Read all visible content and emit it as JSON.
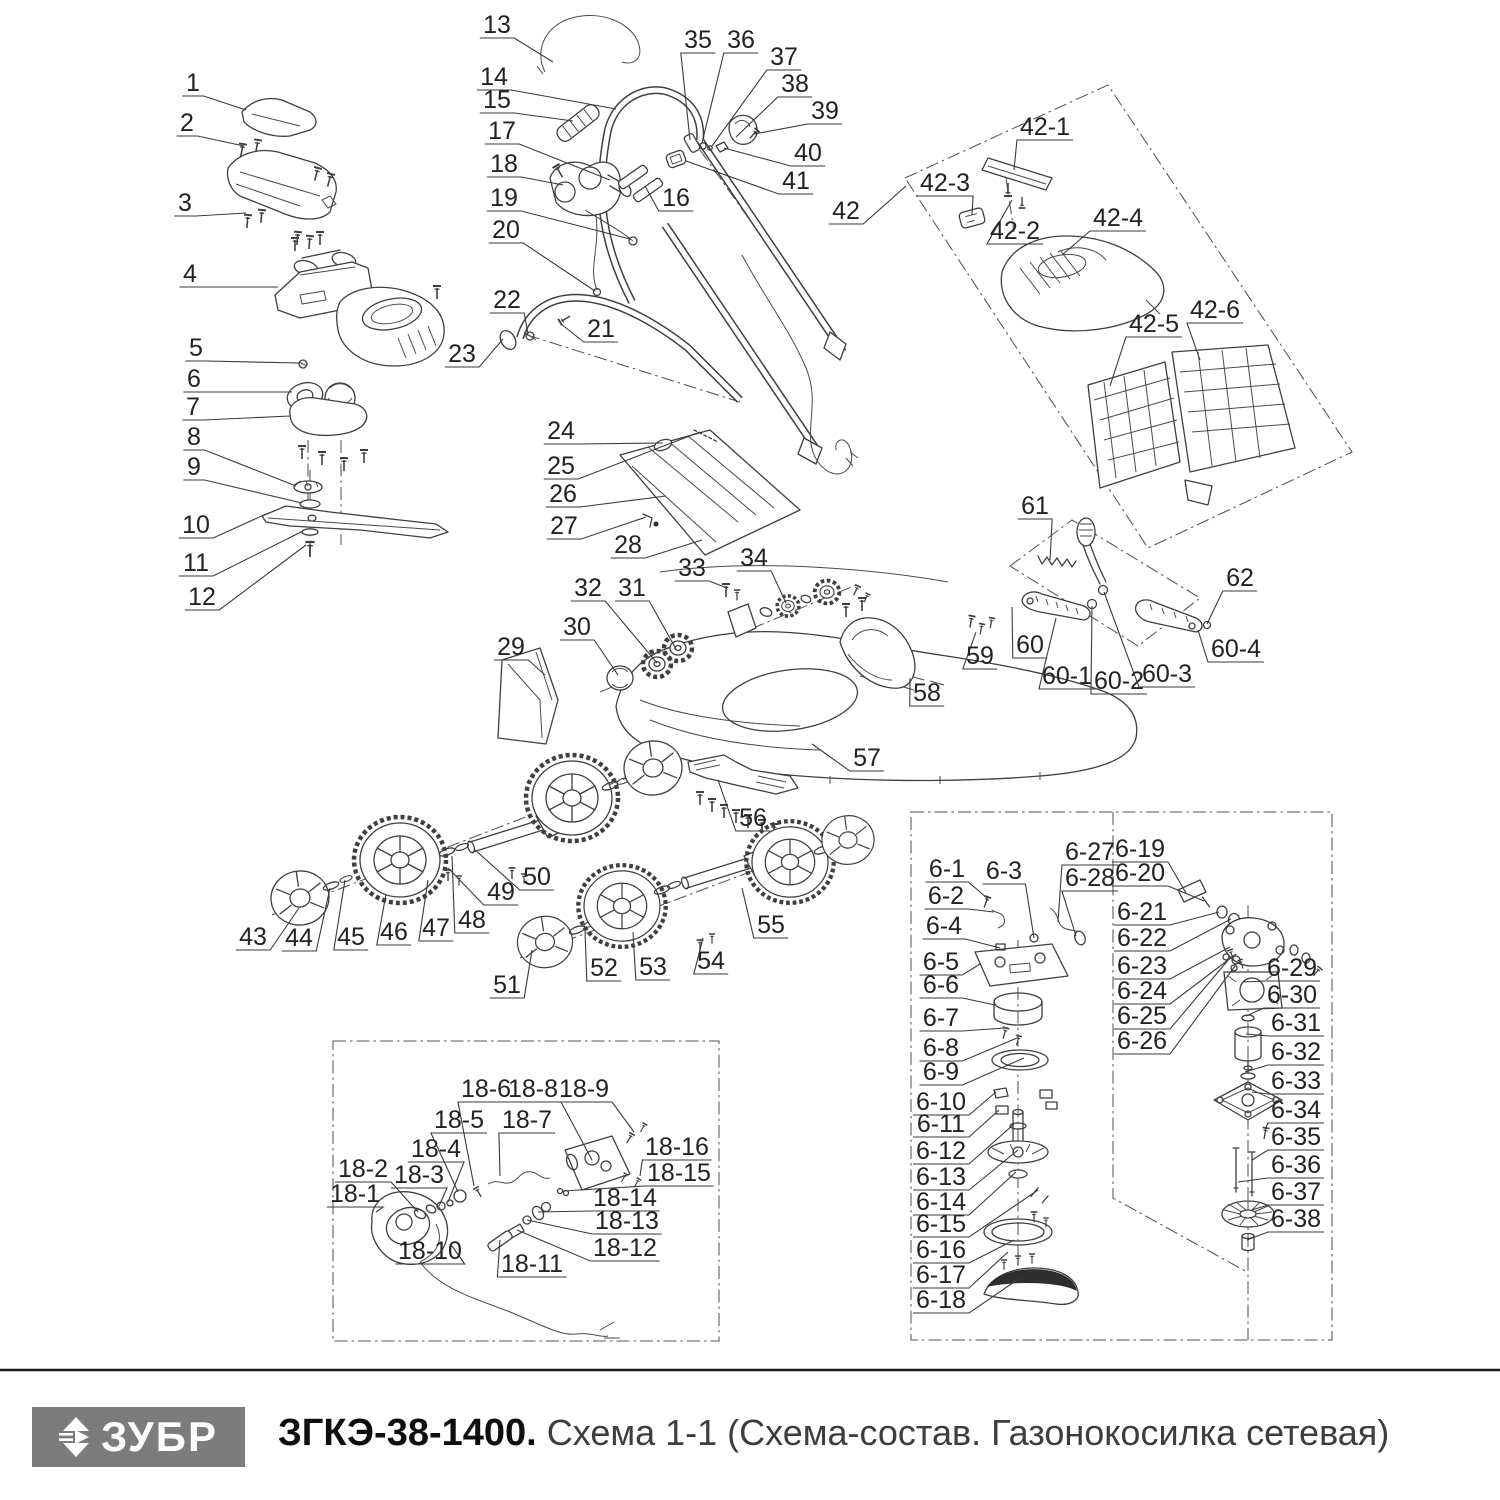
{
  "footer": {
    "logo_text": "ЗУБР",
    "model": "ЗГКЭ-38-1400.",
    "schema_title": "Схема 1-1 (Схема-состав. Газонокосилка сетевая)"
  },
  "callouts": [
    {
      "n": "1",
      "x": 193,
      "y": 82,
      "tx": 246,
      "ty": 110
    },
    {
      "n": "2",
      "x": 187,
      "y": 122,
      "tx": 244,
      "ty": 146
    },
    {
      "n": "3",
      "x": 185,
      "y": 202,
      "tx": 246,
      "ty": 213
    },
    {
      "n": "4",
      "x": 190,
      "y": 273,
      "tx": 278,
      "ty": 287
    },
    {
      "n": "5",
      "x": 196,
      "y": 347,
      "tx": 300,
      "ty": 363
    },
    {
      "n": "6",
      "x": 194,
      "y": 378,
      "tx": 292,
      "ty": 392
    },
    {
      "n": "7",
      "x": 193,
      "y": 406,
      "tx": 290,
      "ty": 416
    },
    {
      "n": "8",
      "x": 194,
      "y": 436,
      "tx": 296,
      "ty": 486
    },
    {
      "n": "9",
      "x": 194,
      "y": 466,
      "tx": 302,
      "ty": 503
    },
    {
      "n": "10",
      "x": 196,
      "y": 524,
      "tx": 266,
      "ty": 514
    },
    {
      "n": "11",
      "x": 196,
      "y": 562,
      "tx": 303,
      "ty": 531
    },
    {
      "n": "12",
      "x": 202,
      "y": 596,
      "tx": 306,
      "ty": 545
    },
    {
      "n": "13",
      "x": 497,
      "y": 24,
      "tx": 553,
      "ty": 62
    },
    {
      "n": "14",
      "x": 494,
      "y": 76,
      "tx": 616,
      "ty": 109
    },
    {
      "n": "15",
      "x": 497,
      "y": 99,
      "tx": 573,
      "ty": 121
    },
    {
      "n": "16",
      "x": 676,
      "y": 197,
      "tx": 645,
      "ty": 186
    },
    {
      "n": "17",
      "x": 502,
      "y": 130,
      "tx": 610,
      "ty": 180
    },
    {
      "n": "18",
      "x": 504,
      "y": 163,
      "tx": 563,
      "ty": 185
    },
    {
      "n": "19",
      "x": 504,
      "y": 197,
      "tx": 630,
      "ty": 239
    },
    {
      "n": "20",
      "x": 506,
      "y": 229,
      "tx": 595,
      "ty": 291
    },
    {
      "n": "21",
      "x": 601,
      "y": 328,
      "tx": 561,
      "ty": 324
    },
    {
      "n": "22",
      "x": 507,
      "y": 299,
      "tx": 528,
      "ty": 334
    },
    {
      "n": "23",
      "x": 462,
      "y": 353,
      "tx": 503,
      "ty": 339
    },
    {
      "n": "24",
      "x": 561,
      "y": 430,
      "tx": 663,
      "ty": 443
    },
    {
      "n": "25",
      "x": 561,
      "y": 465,
      "tx": 700,
      "ty": 432
    },
    {
      "n": "26",
      "x": 563,
      "y": 493,
      "tx": 666,
      "ty": 496
    },
    {
      "n": "27",
      "x": 564,
      "y": 525,
      "tx": 646,
      "ty": 517
    },
    {
      "n": "28",
      "x": 628,
      "y": 544,
      "tx": 702,
      "ty": 540
    },
    {
      "n": "29",
      "x": 511,
      "y": 646,
      "tx": 545,
      "ty": 675
    },
    {
      "n": "30",
      "x": 577,
      "y": 626,
      "tx": 618,
      "ty": 675
    },
    {
      "n": "31",
      "x": 632,
      "y": 587,
      "tx": 676,
      "ty": 649
    },
    {
      "n": "32",
      "x": 588,
      "y": 587,
      "tx": 657,
      "ty": 663
    },
    {
      "n": "33",
      "x": 692,
      "y": 567,
      "tx": 727,
      "ty": 588
    },
    {
      "n": "34",
      "x": 754,
      "y": 557,
      "tx": 786,
      "ty": 603
    },
    {
      "n": "35",
      "x": 698,
      "y": 39,
      "tx": 690,
      "ty": 140
    },
    {
      "n": "36",
      "x": 741,
      "y": 39,
      "tx": 702,
      "ty": 143
    },
    {
      "n": "37",
      "x": 784,
      "y": 56,
      "tx": 712,
      "ty": 146
    },
    {
      "n": "38",
      "x": 795,
      "y": 83,
      "tx": 736,
      "ty": 137
    },
    {
      "n": "39",
      "x": 825,
      "y": 110,
      "tx": 754,
      "ty": 134
    },
    {
      "n": "40",
      "x": 808,
      "y": 152,
      "tx": 724,
      "ty": 148
    },
    {
      "n": "41",
      "x": 796,
      "y": 180,
      "tx": 686,
      "ty": 161
    },
    {
      "n": "42",
      "x": 846,
      "y": 210,
      "tx": 906,
      "ty": 186
    },
    {
      "n": "42-1",
      "x": 1045,
      "y": 126,
      "tx": 1014,
      "ty": 170
    },
    {
      "n": "42-2",
      "x": 1015,
      "y": 230,
      "tx": 1012,
      "ty": 200
    },
    {
      "n": "42-3",
      "x": 945,
      "y": 182,
      "tx": 972,
      "ty": 215
    },
    {
      "n": "42-4",
      "x": 1118,
      "y": 217,
      "tx": 1062,
      "ty": 255
    },
    {
      "n": "42-5",
      "x": 1154,
      "y": 323,
      "tx": 1110,
      "ty": 386
    },
    {
      "n": "42-6",
      "x": 1215,
      "y": 309,
      "tx": 1200,
      "ty": 360
    },
    {
      "n": "43",
      "x": 253,
      "y": 936,
      "tx": 299,
      "ty": 908
    },
    {
      "n": "44",
      "x": 299,
      "y": 937,
      "tx": 330,
      "ty": 888
    },
    {
      "n": "45",
      "x": 351,
      "y": 936,
      "tx": 345,
      "ty": 880
    },
    {
      "n": "46",
      "x": 394,
      "y": 931,
      "tx": 386,
      "ty": 894
    },
    {
      "n": "47",
      "x": 436,
      "y": 927,
      "tx": 428,
      "ty": 880
    },
    {
      "n": "48",
      "x": 472,
      "y": 919,
      "tx": 452,
      "ty": 856
    },
    {
      "n": "49",
      "x": 501,
      "y": 891,
      "tx": 448,
      "ty": 868
    },
    {
      "n": "50",
      "x": 537,
      "y": 876,
      "tx": 474,
      "ty": 849
    },
    {
      "n": "51",
      "x": 507,
      "y": 984,
      "tx": 532,
      "ty": 950
    },
    {
      "n": "52",
      "x": 604,
      "y": 967,
      "tx": 585,
      "ty": 930
    },
    {
      "n": "53",
      "x": 653,
      "y": 966,
      "tx": 633,
      "ty": 932
    },
    {
      "n": "54",
      "x": 711,
      "y": 960,
      "tx": 703,
      "ty": 938
    },
    {
      "n": "55",
      "x": 771,
      "y": 924,
      "tx": 742,
      "ty": 888
    },
    {
      "n": "56",
      "x": 753,
      "y": 817,
      "tx": 718,
      "ty": 780
    },
    {
      "n": "57",
      "x": 867,
      "y": 757,
      "tx": 812,
      "ty": 744
    },
    {
      "n": "58",
      "x": 927,
      "y": 692,
      "tx": 910,
      "ty": 678
    },
    {
      "n": "59",
      "x": 980,
      "y": 655,
      "tx": 976,
      "ty": 632
    },
    {
      "n": "60",
      "x": 1030,
      "y": 644,
      "tx": 1012,
      "ty": 607
    },
    {
      "n": "61",
      "x": 1035,
      "y": 505,
      "tx": 1050,
      "ty": 560
    },
    {
      "n": "62",
      "x": 1240,
      "y": 577,
      "tx": 1207,
      "ty": 624
    },
    {
      "n": "60-1",
      "x": 1067,
      "y": 675,
      "tx": 1056,
      "ty": 618
    },
    {
      "n": "60-2",
      "x": 1119,
      "y": 680,
      "tx": 1092,
      "ty": 606
    },
    {
      "n": "60-3",
      "x": 1167,
      "y": 673,
      "tx": 1104,
      "ty": 592
    },
    {
      "n": "60-4",
      "x": 1236,
      "y": 648,
      "tx": 1198,
      "ty": 630
    },
    {
      "n": "18-1",
      "x": 355,
      "y": 1193,
      "tx": 376,
      "ty": 1212
    },
    {
      "n": "18-2",
      "x": 363,
      "y": 1168,
      "tx": 418,
      "ty": 1212
    },
    {
      "n": "18-3",
      "x": 419,
      "y": 1174,
      "tx": 439,
      "ty": 1206
    },
    {
      "n": "18-4",
      "x": 436,
      "y": 1148,
      "tx": 448,
      "ty": 1202
    },
    {
      "n": "18-5",
      "x": 459,
      "y": 1119,
      "tx": 458,
      "ty": 1192
    },
    {
      "n": "18-6",
      "x": 486,
      "y": 1088,
      "tx": 474,
      "ty": 1186
    },
    {
      "n": "18-7",
      "x": 527,
      "y": 1119,
      "tx": 500,
      "ty": 1176
    },
    {
      "n": "18-8",
      "x": 533,
      "y": 1088,
      "tx": 592,
      "ty": 1160
    },
    {
      "n": "18-9",
      "x": 584,
      "y": 1088,
      "tx": 634,
      "ty": 1132
    },
    {
      "n": "18-10",
      "x": 430,
      "y": 1250,
      "tx": 452,
      "ty": 1246
    },
    {
      "n": "18-11",
      "x": 532,
      "y": 1263,
      "tx": 500,
      "ty": 1240
    },
    {
      "n": "18-12",
      "x": 625,
      "y": 1247,
      "tx": 517,
      "ty": 1230
    },
    {
      "n": "18-13",
      "x": 627,
      "y": 1220,
      "tx": 527,
      "ty": 1220
    },
    {
      "n": "18-14",
      "x": 625,
      "y": 1197,
      "tx": 538,
      "ty": 1212
    },
    {
      "n": "18-15",
      "x": 679,
      "y": 1172,
      "tx": 563,
      "ty": 1191
    },
    {
      "n": "18-16",
      "x": 677,
      "y": 1146,
      "tx": 640,
      "ty": 1176
    },
    {
      "n": "6-1",
      "x": 947,
      "y": 868,
      "tx": 988,
      "ty": 899
    },
    {
      "n": "6-2",
      "x": 946,
      "y": 895,
      "tx": 994,
      "ty": 912
    },
    {
      "n": "6-3",
      "x": 1004,
      "y": 870,
      "tx": 1034,
      "ty": 938
    },
    {
      "n": "6-4",
      "x": 944,
      "y": 925,
      "tx": 1000,
      "ty": 948
    },
    {
      "n": "6-5",
      "x": 941,
      "y": 961,
      "tx": 980,
      "ty": 964
    },
    {
      "n": "6-6",
      "x": 941,
      "y": 984,
      "tx": 995,
      "ty": 1005
    },
    {
      "n": "6-7",
      "x": 941,
      "y": 1017,
      "tx": 1005,
      "ty": 1028
    },
    {
      "n": "6-8",
      "x": 941,
      "y": 1047,
      "tx": 1017,
      "ty": 1038
    },
    {
      "n": "6-9",
      "x": 941,
      "y": 1071,
      "tx": 1024,
      "ty": 1058
    },
    {
      "n": "6-10",
      "x": 941,
      "y": 1101,
      "tx": 996,
      "ty": 1092
    },
    {
      "n": "6-11",
      "x": 941,
      "y": 1123,
      "tx": 999,
      "ty": 1110
    },
    {
      "n": "6-12",
      "x": 941,
      "y": 1150,
      "tx": 1014,
      "ty": 1124
    },
    {
      "n": "6-13",
      "x": 941,
      "y": 1176,
      "tx": 1018,
      "ty": 1150
    },
    {
      "n": "6-14",
      "x": 941,
      "y": 1201,
      "tx": 1016,
      "ty": 1172
    },
    {
      "n": "6-15",
      "x": 941,
      "y": 1223,
      "tx": 1038,
      "ty": 1190
    },
    {
      "n": "6-16",
      "x": 941,
      "y": 1249,
      "tx": 1014,
      "ty": 1240
    },
    {
      "n": "6-17",
      "x": 941,
      "y": 1274,
      "tx": 1008,
      "ty": 1252
    },
    {
      "n": "6-18",
      "x": 941,
      "y": 1299,
      "tx": 1020,
      "ty": 1278
    },
    {
      "n": "6-19",
      "x": 1140,
      "y": 848,
      "tx": 1186,
      "ty": 893
    },
    {
      "n": "6-20",
      "x": 1140,
      "y": 872,
      "tx": 1204,
      "ty": 901
    },
    {
      "n": "6-21",
      "x": 1142,
      "y": 911,
      "tx": 1219,
      "ty": 912
    },
    {
      "n": "6-22",
      "x": 1142,
      "y": 937,
      "tx": 1231,
      "ty": 919
    },
    {
      "n": "6-23",
      "x": 1142,
      "y": 965,
      "tx": 1230,
      "ty": 947
    },
    {
      "n": "6-24",
      "x": 1142,
      "y": 990,
      "tx": 1236,
      "ty": 954
    },
    {
      "n": "6-25",
      "x": 1142,
      "y": 1015,
      "tx": 1229,
      "ty": 959
    },
    {
      "n": "6-26",
      "x": 1142,
      "y": 1040,
      "tx": 1235,
      "ty": 966
    },
    {
      "n": "6-27",
      "x": 1090,
      "y": 851,
      "tx": 1058,
      "ty": 922
    },
    {
      "n": "6-28",
      "x": 1090,
      "y": 877,
      "tx": 1076,
      "ty": 936
    },
    {
      "n": "6-29",
      "x": 1292,
      "y": 967,
      "tx": 1244,
      "ty": 982
    },
    {
      "n": "6-30",
      "x": 1292,
      "y": 994,
      "tx": 1246,
      "ty": 1016
    },
    {
      "n": "6-31",
      "x": 1296,
      "y": 1022,
      "tx": 1246,
      "ty": 1034
    },
    {
      "n": "6-32",
      "x": 1296,
      "y": 1051,
      "tx": 1245,
      "ty": 1072
    },
    {
      "n": "6-33",
      "x": 1296,
      "y": 1080,
      "tx": 1252,
      "ty": 1092
    },
    {
      "n": "6-34",
      "x": 1296,
      "y": 1109,
      "tx": 1265,
      "ty": 1130
    },
    {
      "n": "6-35",
      "x": 1296,
      "y": 1136,
      "tx": 1252,
      "ty": 1160
    },
    {
      "n": "6-36",
      "x": 1296,
      "y": 1164,
      "tx": 1238,
      "ty": 1182
    },
    {
      "n": "6-37",
      "x": 1296,
      "y": 1191,
      "tx": 1252,
      "ty": 1210
    },
    {
      "n": "6-38",
      "x": 1296,
      "y": 1218,
      "tx": 1247,
      "ty": 1240
    }
  ]
}
